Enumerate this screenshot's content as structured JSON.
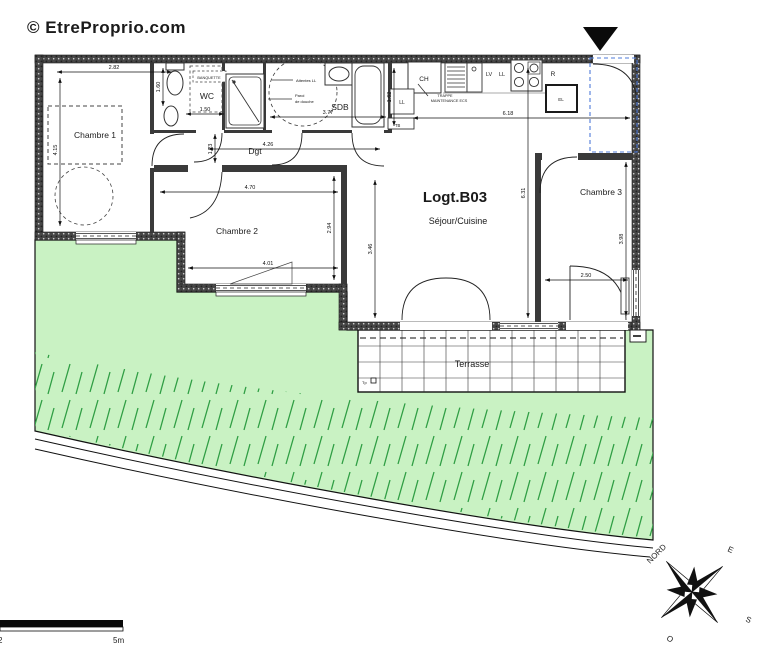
{
  "watermark": "© EtreProprio.com",
  "plan": {
    "logement": "Logt.B03",
    "rooms": {
      "chambre1": "Chambre 1",
      "chambre2": "Chambre 2",
      "chambre3": "Chambre 3",
      "wc": "WC",
      "sdb": "SDB",
      "dgt": "Dgt",
      "sejour": "Séjour/Cuisine",
      "terrasse": "Terrasse"
    },
    "kitchen": {
      "ch": "CH",
      "lv": "LV",
      "ll": "LL",
      "r": "R"
    },
    "annotations": {
      "banquette": "BANQUETTE",
      "attentes_ll": "Attentes LL",
      "paroi_line1": "Paroi",
      "paroi_line2": "de douche",
      "trappe_line1": "TRAPPE",
      "trappe_line2": "MAINTENANCE ECS",
      "ll_closet": "LL",
      "tb": "TB",
      "el": "EL",
      "tp": "Tp"
    },
    "dimensions": {
      "chambre1_width": "2.82",
      "chambre1_height": "4.15",
      "wc_height": "1.60",
      "wc_width": "1.50",
      "sdb_width": "3.77",
      "sdb_height": "1.62",
      "kitchen_width": "6.18",
      "dgt_width": "4.26",
      "dgt_height": "1.23",
      "chambre2_width_top": "4.70",
      "chambre2_height": "2.94",
      "chambre2_width_bottom": "4.01",
      "sejour_height_left": "3.46",
      "sejour_height_right": "6.31",
      "chambre3_width": "2.50",
      "chambre3_height": "3.98"
    }
  },
  "compass": {
    "north": "NORD",
    "east": "E",
    "south": "S",
    "west": "O"
  },
  "scale_bar": {
    "origin": "2",
    "label": "5m"
  },
  "colors": {
    "grass_fill": "#c9f2c3",
    "grass_stroke": "#2f9e44",
    "wall": "#3f3f3f",
    "dashed_blue": "#4f7bd9",
    "watermark": "#dcdcdc",
    "terrasse_text": "#5a6b7a"
  }
}
